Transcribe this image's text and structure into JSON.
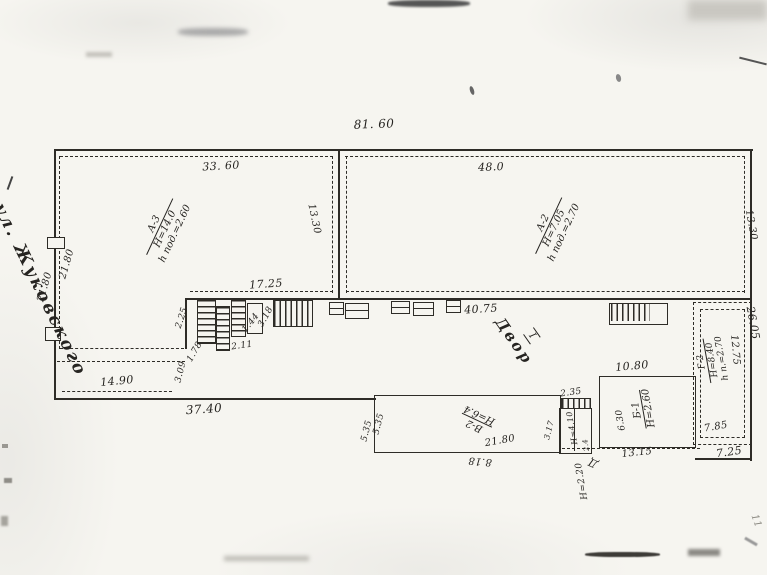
{
  "document": {
    "kind": "scanned site plan (handwritten, Russian)",
    "street_name": "ул. Жуковского",
    "courtyard_label": "Двор",
    "courtyard_number": "I"
  },
  "buildings": [
    {
      "id": "А-3",
      "height": "Н=14.0",
      "basement": "h под.=2.60"
    },
    {
      "id": "А-2",
      "height": "Н=7.05",
      "basement": "h под.=2.70"
    },
    {
      "id": "Б-1",
      "height": "Н=2.60"
    },
    {
      "id": "В-2",
      "height": "Н=6.4"
    },
    {
      "id": "Г-2",
      "height": "Н=8.40",
      "basement": "h п.=2.70"
    },
    {
      "id": "Д",
      "height": "Н=2.20"
    }
  ],
  "plan": {
    "labels": [
      {
        "name": "street-name-label",
        "text": "ул. Жуковского",
        "x": 40,
        "y": 290,
        "r": 64,
        "s": 17,
        "cls": "cursive"
      },
      {
        "name": "dim-top-total",
        "text": "81. 60",
        "x": 374,
        "y": 124,
        "r": -2,
        "s": 12
      },
      {
        "name": "dim-a3-front",
        "text": "33. 60",
        "x": 221,
        "y": 166,
        "r": -3,
        "s": 11
      },
      {
        "name": "dim-a2-front",
        "text": "48.0",
        "x": 491,
        "y": 167,
        "r": -2,
        "s": 11
      },
      {
        "name": "dim-a-divider",
        "text": "13.30",
        "x": 314,
        "y": 219,
        "r": 78,
        "s": 10
      },
      {
        "name": "dim-a2-east",
        "text": "13.30",
        "x": 751,
        "y": 225,
        "r": 80,
        "s": 10
      },
      {
        "name": "dim-yard-wall",
        "text": "17.25",
        "x": 266,
        "y": 284,
        "r": -4,
        "s": 11
      },
      {
        "name": "dim-west-outer",
        "text": "21.80",
        "x": 45,
        "y": 287,
        "r": -74,
        "s": 10
      },
      {
        "name": "dim-west-inner",
        "text": "21.80",
        "x": 67,
        "y": 264,
        "r": -74,
        "s": 10
      },
      {
        "name": "dim-garden",
        "text": "14.90",
        "x": 117,
        "y": 381,
        "r": -5,
        "s": 11
      },
      {
        "name": "dim-south-boundary",
        "text": "37.40",
        "x": 204,
        "y": 409,
        "r": -4,
        "s": 12
      },
      {
        "name": "dim-porch-2-25",
        "text": "2.25",
        "x": 182,
        "y": 318,
        "r": -72,
        "s": 9
      },
      {
        "name": "dim-porch-1-78",
        "text": "1.78",
        "x": 195,
        "y": 352,
        "r": -60,
        "s": 9
      },
      {
        "name": "dim-jog-3-09",
        "text": "3.09",
        "x": 181,
        "y": 372,
        "r": -76,
        "s": 9
      },
      {
        "name": "dim-porch-2-11",
        "text": "2.11",
        "x": 242,
        "y": 346,
        "r": -8,
        "s": 9
      },
      {
        "name": "dim-porch-1-44",
        "text": "1.44",
        "x": 251,
        "y": 323,
        "r": -52,
        "s": 9
      },
      {
        "name": "dim-porch-3-18",
        "text": "3.18",
        "x": 266,
        "y": 317,
        "r": -62,
        "s": 9
      },
      {
        "name": "dim-yard-40-75",
        "text": "40.75",
        "x": 481,
        "y": 309,
        "r": -4,
        "s": 11
      },
      {
        "name": "courtyard-label",
        "text": "Двор",
        "x": 514,
        "y": 341,
        "r": 55,
        "s": 15,
        "cls": "cursive"
      },
      {
        "name": "courtyard-number",
        "text": "I",
        "x": 532,
        "y": 336,
        "r": 55,
        "s": 10,
        "cls": "cynum"
      },
      {
        "name": "dim-v2-west-outer",
        "text": "5.35",
        "x": 367,
        "y": 431,
        "r": -76,
        "s": 9
      },
      {
        "name": "dim-v2-west-inner",
        "text": "5.35",
        "x": 379,
        "y": 424,
        "r": -76,
        "s": 9
      },
      {
        "name": "dim-v2-length",
        "text": "21.80",
        "x": 500,
        "y": 441,
        "r": -10,
        "s": 10
      },
      {
        "name": "dim-v2-south",
        "text": "8.18",
        "x": 480,
        "y": 461,
        "r": 185,
        "s": 10
      },
      {
        "name": "dim-cell-2-35",
        "text": "2.35",
        "x": 571,
        "y": 393,
        "r": -8,
        "s": 9
      },
      {
        "name": "dim-cell-3-17",
        "text": "3.17",
        "x": 549,
        "y": 430,
        "r": -76,
        "s": 8
      },
      {
        "name": "cell-height-label",
        "text": "Н=4.10",
        "x": 572,
        "y": 428,
        "r": 260,
        "s": 8
      },
      {
        "name": "dim-cell-2-4",
        "text": "2.4",
        "x": 586,
        "y": 445,
        "r": 260,
        "s": 7
      },
      {
        "name": "dim-b1-top",
        "text": "10.80",
        "x": 632,
        "y": 366,
        "r": -5,
        "s": 11
      },
      {
        "name": "dim-b1-west",
        "text": "6.30",
        "x": 621,
        "y": 420,
        "r": 260,
        "s": 9
      },
      {
        "name": "dim-dashdot-13-15",
        "text": "13.15",
        "x": 637,
        "y": 453,
        "r": -6,
        "s": 10
      },
      {
        "name": "shed-d-label",
        "text": "Д",
        "x": 593,
        "y": 463,
        "r": 205,
        "s": 11
      },
      {
        "name": "shed-d-height",
        "text": "Н=2.20",
        "x": 582,
        "y": 481,
        "r": 260,
        "s": 9
      },
      {
        "name": "dim-g2-west",
        "text": "12.75",
        "x": 735,
        "y": 350,
        "r": 85,
        "s": 10
      },
      {
        "name": "dim-east-26-05",
        "text": "26.05",
        "x": 753,
        "y": 323,
        "r": 80,
        "s": 11
      },
      {
        "name": "dim-g2-7-85",
        "text": "7.85",
        "x": 716,
        "y": 427,
        "r": -10,
        "s": 10
      },
      {
        "name": "dim-se-7-25",
        "text": "7.25",
        "x": 729,
        "y": 452,
        "r": -8,
        "s": 11
      },
      {
        "name": "margin-mark-11",
        "text": "11",
        "x": 756,
        "y": 521,
        "r": 70,
        "s": 10,
        "cls": "faint"
      }
    ],
    "blocks": [
      {
        "name": "building-a3-label",
        "x": 165,
        "y": 229,
        "r": -65,
        "s": 10,
        "lines": [
          "А-3",
          "Н=14.0",
          "h под.=2.60"
        ]
      },
      {
        "name": "building-a2-label",
        "x": 554,
        "y": 228,
        "r": -65,
        "s": 10,
        "lines": [
          "А-2",
          "Н=7.05",
          "h под.=2.70"
        ]
      },
      {
        "name": "building-v2-label",
        "x": 477,
        "y": 420,
        "r": 205,
        "s": 10,
        "lines": [
          "В-2",
          "Н=6.4"
        ]
      },
      {
        "name": "building-b1-label",
        "x": 643,
        "y": 409,
        "r": 260,
        "s": 10,
        "lines": [
          "Б-1",
          "Н=2.60"
        ]
      },
      {
        "name": "building-g2-label",
        "x": 712,
        "y": 360,
        "r": 260,
        "s": 9,
        "lines": [
          "Г-2",
          "Н=8.40",
          "h п.=2.70"
        ]
      }
    ]
  }
}
